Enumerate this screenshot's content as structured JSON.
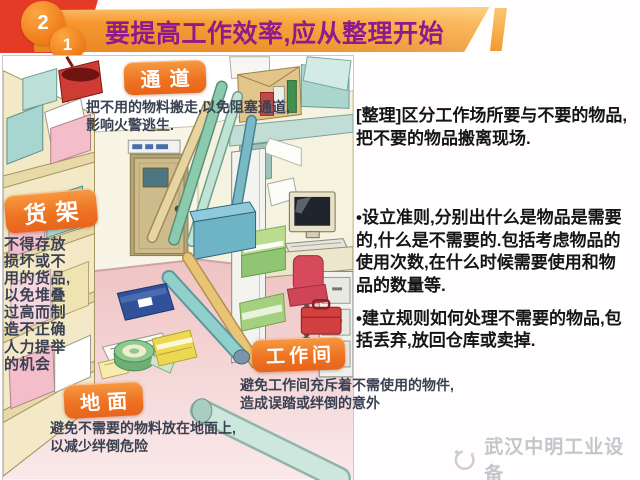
{
  "header": {
    "badge_top": "2",
    "badge_bottom": "1",
    "title": "要提高工作效率,应从整理开始"
  },
  "labels": {
    "passage": {
      "title": "通道",
      "note": "把不用的物料搬走,以免阻塞通道,\n影响火警逃生."
    },
    "shelf": {
      "title": "货架",
      "note": "不得存放损坏或不用的货品,以免堆叠过高而制造不正确人力提举的机会"
    },
    "workshop": {
      "title": "工作间",
      "note": "避免工作间充斥着不需使用的物件,\n造成误踏或绊倒的意外"
    },
    "floor": {
      "title": "地面",
      "note": "避免不需要的物料放在地面上,\n以减少绊倒危险"
    }
  },
  "sidebar": {
    "intro": "[整理]区分工作场所要与不要的物品,把不要的物品搬离现场.",
    "bullets": [
      "•设立准则,分别出什么是物品是需要的,什么是不需要的.包括考虑物品的使用次数,在什么时候需要使用和物品的数量等.",
      "•建立规则如何处理不需要的物品,包括丢弃,放回仓库或卖掉."
    ]
  },
  "footer": {
    "brand": "武汉中明工业设备"
  },
  "colors": {
    "banner_orange": "#f79d33",
    "backing_red": "#e33b26",
    "title_purple": "#8e1a8c",
    "tag_orange": "#ee7423",
    "note_text": "#3a4152",
    "body_text": "#151515",
    "floor_pink": "#f0c6c6",
    "wall_cream": "#f5f2df",
    "brand_gray": "#c5c5cb"
  }
}
